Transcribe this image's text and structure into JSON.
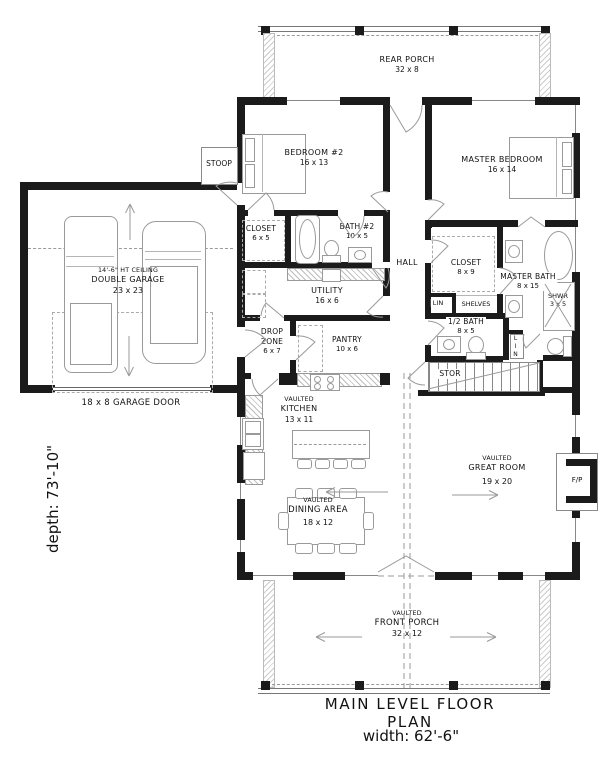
{
  "colors": {
    "wall": "#1b1b1b",
    "line": "#9a9a9a",
    "background": "#ffffff"
  },
  "plan": {
    "title": "MAIN LEVEL FLOOR PLAN",
    "width_label": "width: 62'-6\"",
    "depth_label": "depth: 73'-10\""
  },
  "rooms": {
    "rear_porch": {
      "name": "REAR PORCH",
      "dims": "32 x 8"
    },
    "bedroom2": {
      "name": "BEDROOM #2",
      "dims": "16 x 13"
    },
    "master_bedroom": {
      "name": "MASTER BEDROOM",
      "dims": "16 x 14"
    },
    "stoop": {
      "name": "STOOP"
    },
    "closet_bed2": {
      "name": "CLOSET",
      "dims": "6 x 5"
    },
    "bath2": {
      "name": "BATH #2",
      "dims": "10 x 5"
    },
    "hall": {
      "name": "HALL"
    },
    "master_closet": {
      "name": "CLOSET",
      "dims": "8 x 9"
    },
    "master_bath": {
      "name": "MASTER BATH",
      "dims": "8 x 15"
    },
    "shower": {
      "name": "SHWR",
      "dims": "3 x 5"
    },
    "linen1": {
      "name": "LIN"
    },
    "linen2": {
      "name": "LIN"
    },
    "shelves": {
      "name": "SHELVES"
    },
    "half_bath": {
      "name": "1/2 BATH",
      "dims": "8 x 5"
    },
    "utility": {
      "name": "UTILITY",
      "dims": "16 x 6"
    },
    "drop_zone": {
      "name": "DROP ZONE",
      "dims": "6 x 7"
    },
    "pantry": {
      "name": "PANTRY",
      "dims": "10 x 6"
    },
    "storage": {
      "name": "STOR"
    },
    "garage": {
      "ceiling": "14'-6\" HT CEILING",
      "name": "DOUBLE GARAGE",
      "dims": "23 x 23"
    },
    "garage_door": {
      "label": "18 x 8 GARAGE DOOR"
    },
    "kitchen": {
      "tag": "VAULTED",
      "name": "KITCHEN",
      "dims": "13 x 11"
    },
    "great_room": {
      "tag": "VAULTED",
      "name": "GREAT ROOM",
      "dims": "19 x 20"
    },
    "dining": {
      "tag": "VAULTED",
      "name": "DINING AREA",
      "dims": "18 x 12"
    },
    "front_porch": {
      "tag": "VAULTED",
      "name": "FRONT PORCH",
      "dims": "32 x 12"
    },
    "fireplace": {
      "name": "F/P"
    }
  }
}
